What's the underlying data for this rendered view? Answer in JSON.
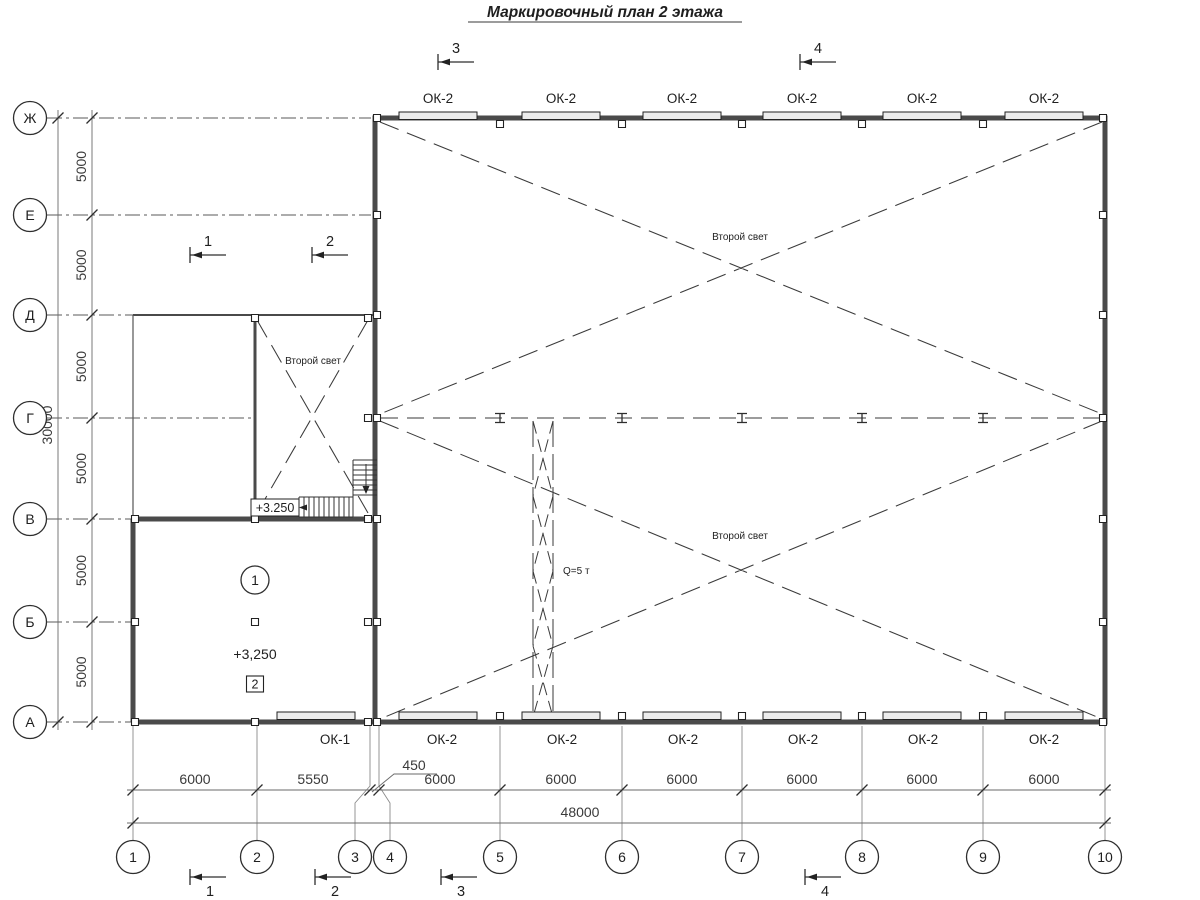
{
  "title": "Маркировочный план 2 этажа",
  "grid": {
    "row_labels": [
      "Ж",
      "Е",
      "Д",
      "Г",
      "В",
      "Б",
      "А"
    ],
    "col_labels": [
      "1",
      "2",
      "3",
      "4",
      "5",
      "6",
      "7",
      "8",
      "9",
      "10"
    ]
  },
  "dims": {
    "v_bays": [
      "5000",
      "5000",
      "5000",
      "5000",
      "5000",
      "5000"
    ],
    "v_total": "30000",
    "h_bays": [
      "6000",
      "5550",
      "6000",
      "6000",
      "6000",
      "6000",
      "6000",
      "6000"
    ],
    "h_offset": "450",
    "h_total": "48000"
  },
  "windows": {
    "top": [
      "ОК-2",
      "ОК-2",
      "ОК-2",
      "ОК-2",
      "ОК-2",
      "ОК-2"
    ],
    "bottom": [
      "ОК-2",
      "ОК-2",
      "ОК-2",
      "ОК-2",
      "ОК-2",
      "ОК-2"
    ],
    "bottom_left": "ОК-1"
  },
  "labels": {
    "second_light_upper": "Второй свет",
    "second_light_lower": "Второй свет",
    "second_light_room": "Второй свет",
    "crane": "Q=5 т",
    "stair_level": "+3.250",
    "room_level": "+3,250",
    "room_number": "1",
    "room_tag": "2"
  },
  "sections": {
    "top": [
      "3",
      "4"
    ],
    "middle": [
      "1",
      "2"
    ],
    "bottom": [
      "1",
      "2",
      "3",
      "4"
    ]
  }
}
